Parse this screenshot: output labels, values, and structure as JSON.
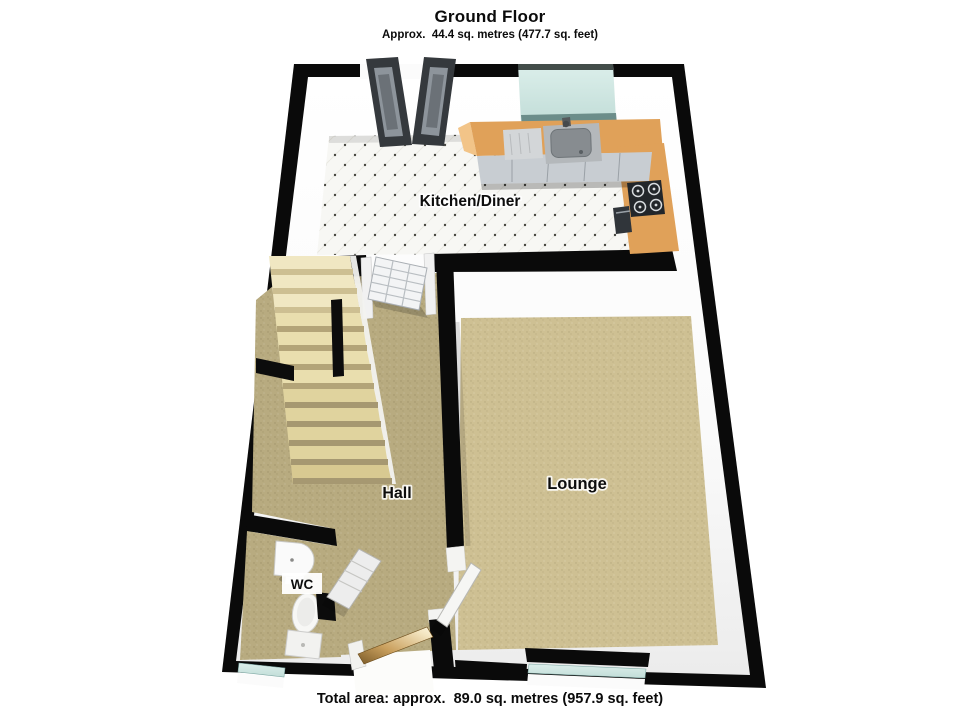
{
  "header": {
    "title": "Ground Floor",
    "subtitle": "Approx.  44.4 sq. metres (477.7 sq. feet)"
  },
  "rooms": {
    "kitchen": {
      "label": "Kitchen/Diner"
    },
    "hall": {
      "label": "Hall"
    },
    "lounge": {
      "label": "Lounge"
    },
    "wc": {
      "label": "WC"
    }
  },
  "footer": {
    "total_area": "Total area: approx.  89.0 sq. metres (957.9 sq. feet)"
  },
  "colors": {
    "wall": "#0a0a0a",
    "kitchen_tile": "#f7f7f4",
    "lounge_carpet": "#cec093",
    "hall_carpet": "#b8ab80",
    "wc_floor": "#b3a67c",
    "stair_tread_light": "#f0e7c2",
    "stair_tread_mid": "#e9deae",
    "stair_tread_dark": "#e0d39e",
    "counter_wood": "#e0a159",
    "counter_end": "#f2c488",
    "cabinet_front": "#c8cdd2",
    "window_glass": "#cfe7e3",
    "door_dark": "#35393d",
    "threshold_wood": "#d9b06a"
  }
}
